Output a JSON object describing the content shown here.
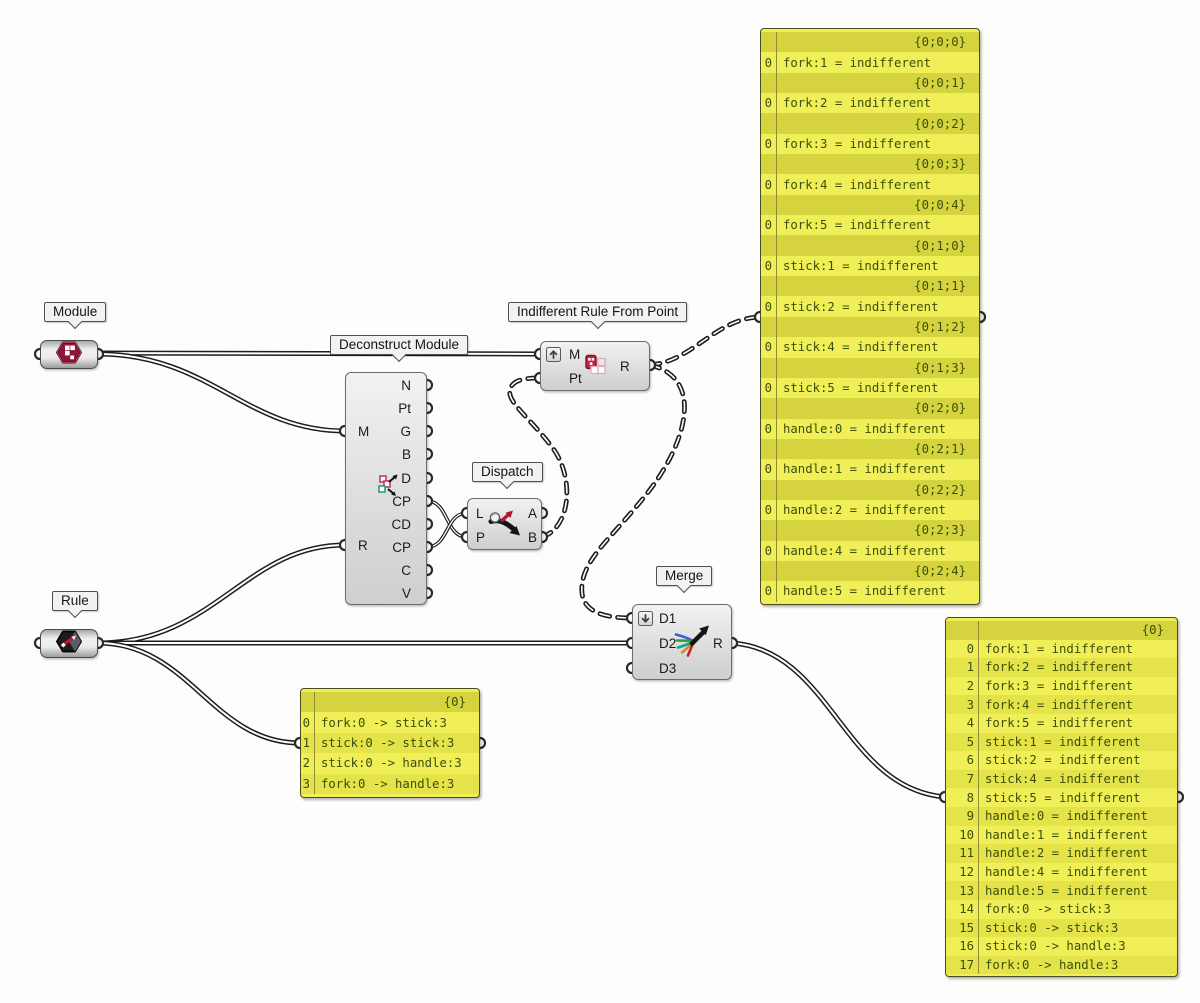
{
  "app": "Grasshopper node canvas",
  "colors": {
    "canvas_bg": "#fdfdfc",
    "panel_light": "#f0ef58",
    "panel_dark": "#d5d43e",
    "panel_text": "#3c4e0a",
    "wire": "#1d1d1d",
    "module_icon_red": "#8e1638",
    "rule_arrow_red": "#c01535"
  },
  "components": {
    "module": {
      "label": "Module"
    },
    "rule": {
      "label": "Rule"
    },
    "deconstruct": {
      "label": "Deconstruct Module",
      "inputs": [
        "M",
        "R"
      ],
      "outputs": [
        "N",
        "Pt",
        "G",
        "B",
        "D",
        "CP",
        "CD",
        "CP",
        "C",
        "V"
      ]
    },
    "irfp": {
      "label": "Indifferent Rule From Point",
      "inputs": [
        "M",
        "Pt"
      ],
      "outputs": [
        "R"
      ],
      "input_modifier": "graft-up-arrow"
    },
    "dispatch": {
      "label": "Dispatch",
      "inputs": [
        "L",
        "P"
      ],
      "outputs": [
        "A",
        "B"
      ]
    },
    "merge": {
      "label": "Merge",
      "inputs": [
        "D1",
        "D2",
        "D3"
      ],
      "outputs": [
        "R"
      ],
      "input_modifier": "flatten-down-arrow"
    }
  },
  "panels": {
    "rules_tree": {
      "rows": [
        {
          "type": "path",
          "index": "",
          "text": "{0;0;0}"
        },
        {
          "type": "item",
          "index": "0",
          "text": "fork:1 = indifferent"
        },
        {
          "type": "path",
          "index": "",
          "text": "{0;0;1}"
        },
        {
          "type": "item",
          "index": "0",
          "text": "fork:2 = indifferent"
        },
        {
          "type": "path",
          "index": "",
          "text": "{0;0;2}"
        },
        {
          "type": "item",
          "index": "0",
          "text": "fork:3 = indifferent"
        },
        {
          "type": "path",
          "index": "",
          "text": "{0;0;3}"
        },
        {
          "type": "item",
          "index": "0",
          "text": "fork:4 = indifferent"
        },
        {
          "type": "path",
          "index": "",
          "text": "{0;0;4}"
        },
        {
          "type": "item",
          "index": "0",
          "text": "fork:5 = indifferent"
        },
        {
          "type": "path",
          "index": "",
          "text": "{0;1;0}"
        },
        {
          "type": "item",
          "index": "0",
          "text": "stick:1 = indifferent"
        },
        {
          "type": "path",
          "index": "",
          "text": "{0;1;1}"
        },
        {
          "type": "item",
          "index": "0",
          "text": "stick:2 = indifferent"
        },
        {
          "type": "path",
          "index": "",
          "text": "{0;1;2}"
        },
        {
          "type": "item",
          "index": "0",
          "text": "stick:4 = indifferent"
        },
        {
          "type": "path",
          "index": "",
          "text": "{0;1;3}"
        },
        {
          "type": "item",
          "index": "0",
          "text": "stick:5 = indifferent"
        },
        {
          "type": "path",
          "index": "",
          "text": "{0;2;0}"
        },
        {
          "type": "item",
          "index": "0",
          "text": "handle:0 = indifferent"
        },
        {
          "type": "path",
          "index": "",
          "text": "{0;2;1}"
        },
        {
          "type": "item",
          "index": "0",
          "text": "handle:1 = indifferent"
        },
        {
          "type": "path",
          "index": "",
          "text": "{0;2;2}"
        },
        {
          "type": "item",
          "index": "0",
          "text": "handle:2 = indifferent"
        },
        {
          "type": "path",
          "index": "",
          "text": "{0;2;3}"
        },
        {
          "type": "item",
          "index": "0",
          "text": "handle:4 = indifferent"
        },
        {
          "type": "path",
          "index": "",
          "text": "{0;2;4}"
        },
        {
          "type": "item",
          "index": "0",
          "text": "handle:5 = indifferent"
        }
      ]
    },
    "rules_explicit": {
      "rows": [
        {
          "type": "path",
          "index": "",
          "text": "{0}"
        },
        {
          "type": "item",
          "index": "0",
          "text": "fork:0 -> stick:3"
        },
        {
          "type": "item",
          "index": "1",
          "text": "stick:0 -> stick:3"
        },
        {
          "type": "item",
          "index": "2",
          "text": "stick:0 -> handle:3"
        },
        {
          "type": "item",
          "index": "3",
          "text": "fork:0 -> handle:3"
        }
      ]
    },
    "rules_merged": {
      "rows": [
        {
          "type": "path",
          "index": "",
          "text": "{0}"
        },
        {
          "type": "item",
          "index": "0",
          "text": "fork:1 = indifferent"
        },
        {
          "type": "item",
          "index": "1",
          "text": "fork:2 = indifferent"
        },
        {
          "type": "item",
          "index": "2",
          "text": "fork:3 = indifferent"
        },
        {
          "type": "item",
          "index": "3",
          "text": "fork:4 = indifferent"
        },
        {
          "type": "item",
          "index": "4",
          "text": "fork:5 = indifferent"
        },
        {
          "type": "item",
          "index": "5",
          "text": "stick:1 = indifferent"
        },
        {
          "type": "item",
          "index": "6",
          "text": "stick:2 = indifferent"
        },
        {
          "type": "item",
          "index": "7",
          "text": "stick:4 = indifferent"
        },
        {
          "type": "item",
          "index": "8",
          "text": "stick:5 = indifferent"
        },
        {
          "type": "item",
          "index": "9",
          "text": "handle:0 = indifferent"
        },
        {
          "type": "item",
          "index": "10",
          "text": "handle:1 = indifferent"
        },
        {
          "type": "item",
          "index": "11",
          "text": "handle:2 = indifferent"
        },
        {
          "type": "item",
          "index": "12",
          "text": "handle:4 = indifferent"
        },
        {
          "type": "item",
          "index": "13",
          "text": "handle:5 = indifferent"
        },
        {
          "type": "item",
          "index": "14",
          "text": "fork:0 -> stick:3"
        },
        {
          "type": "item",
          "index": "15",
          "text": "stick:0 -> stick:3"
        },
        {
          "type": "item",
          "index": "16",
          "text": "stick:0 -> handle:3"
        },
        {
          "type": "item",
          "index": "17",
          "text": "fork:0 -> handle:3"
        }
      ]
    }
  }
}
